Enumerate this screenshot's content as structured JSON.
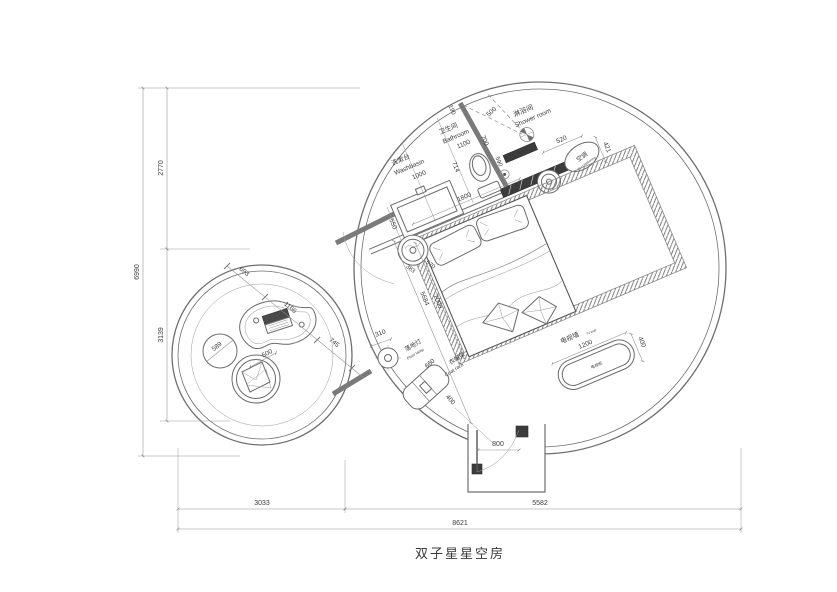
{
  "title": "双子星星空房",
  "labels": {
    "washbasin_zh": "洗漱台",
    "washbasin_en": "Washbasin",
    "bathroom_zh": "卫生间",
    "bathroom_en": "Bathroom",
    "shower_zh": "淋浴间",
    "shower_en": "Shower room",
    "ac_zh": "空调",
    "ac_en": "air-conditioning",
    "tv_wall_zh": "电视墙",
    "tv_wall_en": "TV wall",
    "tv_cabinet_zh": "电视柜",
    "lamp_zh": "落地灯",
    "lamp_en": "Floor lamp",
    "coat_zh": "衣帽架",
    "coat_en": "Coat rack"
  },
  "dims": {
    "v_total": "6990",
    "v_upper": "2770",
    "v_lower": "3139",
    "h_left": "3033",
    "h_right": "5582",
    "h_total": "8621",
    "washbasin_len": "1000",
    "washbasin_dep": "550",
    "bathroom_w": "1100",
    "toilet": "714",
    "wall_top": "190",
    "partition": "700",
    "drain": "590",
    "shower_door": "500",
    "shower_head": "520",
    "ac": "421",
    "bed_w": "1800",
    "bed_l": "2000",
    "diagonal": "5684",
    "stool_a": "383",
    "stool_b": "570",
    "tv_len": "1200",
    "tv_dep": "400",
    "entry": "800",
    "lamp": "310",
    "coat_len": "660",
    "coat_dep": "400",
    "lc_1": "693",
    "lc_2": "1166",
    "lc_3": "745",
    "pouf": "589",
    "cushion": "500"
  },
  "colors": {
    "line": "#6f6f6f",
    "dark_fill": "#3c3c3c",
    "text": "#3a3a3a"
  }
}
